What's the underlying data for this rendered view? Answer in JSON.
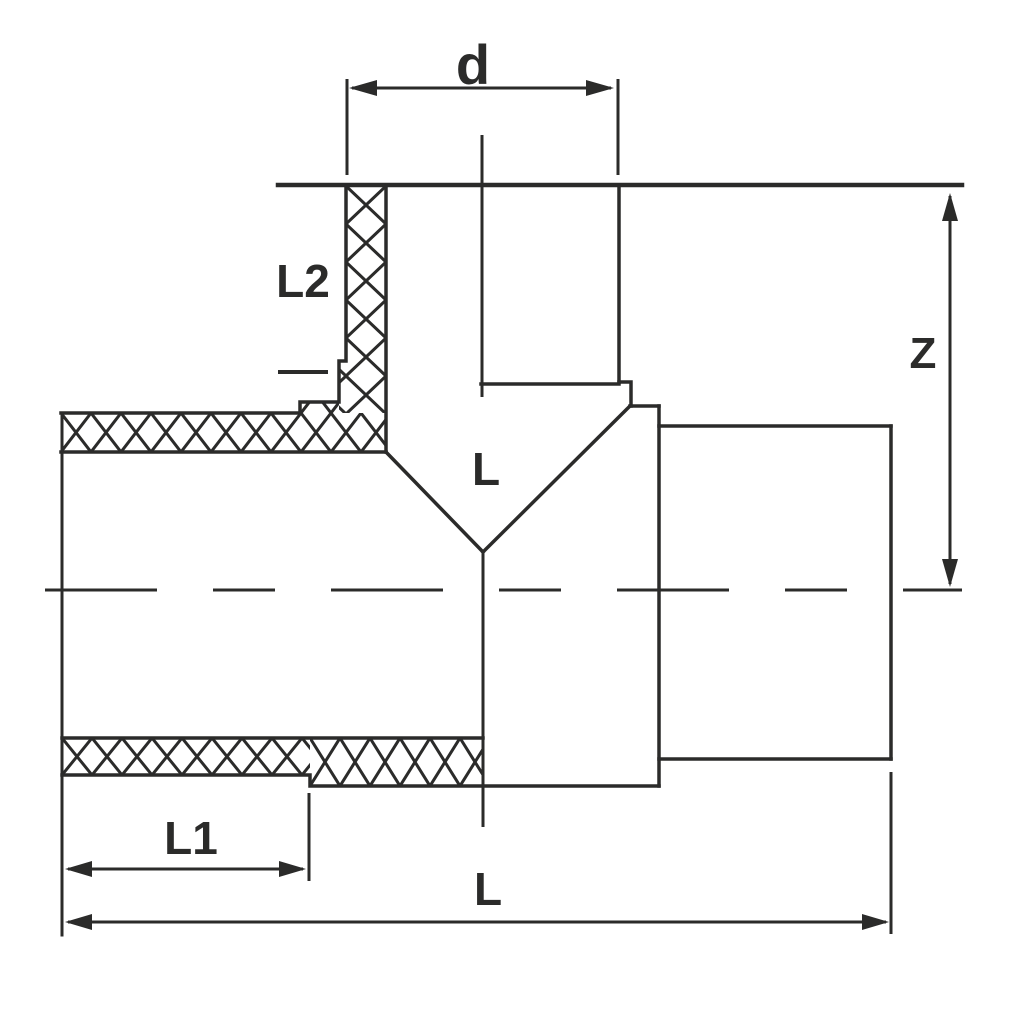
{
  "drawing": {
    "description": "Technical dimension drawing of a tee pipe fitting with crosshatched fusion zones",
    "view": "section elevation",
    "labels": {
      "branch_diameter": "d",
      "branch_socket_depth": "L2",
      "branch_height": "Z",
      "center_length": "L",
      "spigot_length": "L1",
      "overall_length": "L"
    },
    "colors": {
      "line": "#2b2b2a",
      "background": "#ffffff"
    }
  }
}
